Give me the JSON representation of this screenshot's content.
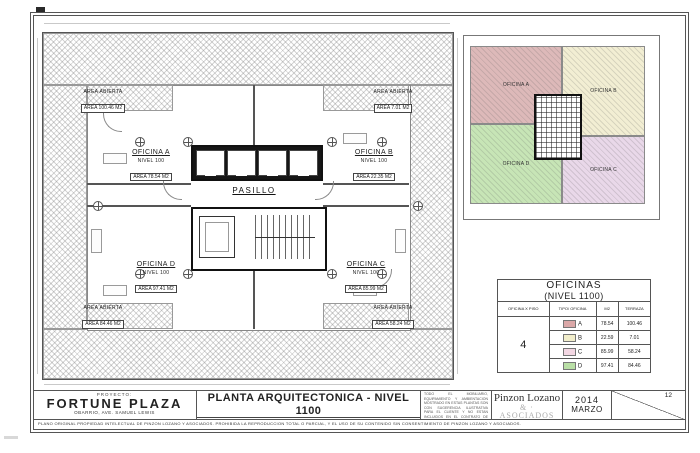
{
  "plan": {
    "corridor_label": "PASILLO",
    "offices": {
      "a": {
        "name": "OFICINA A",
        "level": "NIVEL 100",
        "area": "AREA 78.54 M2"
      },
      "b": {
        "name": "OFICINA B",
        "level": "NIVEL 100",
        "area": "AREA 22.35 M2"
      },
      "c": {
        "name": "OFICINA C",
        "level": "NIVEL 100",
        "area": "AREA 85.99 M2"
      },
      "d": {
        "name": "OFICINA D",
        "level": "NIVEL 100",
        "area": "AREA 97.41 M2"
      }
    },
    "terraces": {
      "top_left": {
        "label": "AREA ABIERTA",
        "area": "AREA 100.46 M2"
      },
      "top_right": {
        "label": "AREA ABIERTA",
        "area": "AREA 7.01 M2"
      },
      "bottom_left": {
        "label": "AREA ABIERTA",
        "area": "AREA 84.46 M2"
      },
      "bottom_right": {
        "label": "AREA ABIERTA",
        "area": "AREA 58.24 M2"
      }
    }
  },
  "key_plan": {
    "zones": {
      "a": {
        "label": "OFICINA A",
        "color": "#ddb9b9"
      },
      "b": {
        "label": "OFICINA B",
        "color": "#f2eed3"
      },
      "c": {
        "label": "OFICINA C",
        "color": "#e9d8e9"
      },
      "d": {
        "label": "OFICINA D",
        "color": "#c7e5b6"
      }
    }
  },
  "table": {
    "title_line1": "OFICINAS",
    "title_line2": "(NIVEL 1100)",
    "headers": {
      "col1": "OFICINA X PISO",
      "col2": "TIPO/ OFICINA",
      "col3": "M2",
      "col4": "TERRAZA"
    },
    "floor_value": "4",
    "rows": [
      {
        "office": "A",
        "m2": "78.54",
        "terraza": "100.46",
        "color": "#dba8a8"
      },
      {
        "office": "B",
        "m2": "22.59",
        "terraza": "7.01",
        "color": "#f2eecb"
      },
      {
        "office": "C",
        "m2": "85.99",
        "terraza": "58.24",
        "color": "#f3d7e3"
      },
      {
        "office": "D",
        "m2": "97.41",
        "terraza": "84.46",
        "color": "#b9dfa6"
      }
    ]
  },
  "title_block": {
    "project_label": "PROYECTO:",
    "project_name": "FORTUNE PLAZA",
    "project_address": "OBARRIO, AVE. SAMUEL LEWIS",
    "drawing_title": "PLANTA ARQUITECTONICA - NIVEL 1100",
    "drawing_subtitle": "OFICINAS",
    "scale_label": "ESCALA 1:50",
    "updated_line": "A C T U A L I Z A D O   12   ( M A R Z O / 2 0 1 4",
    "notes_p1": "TODO EL MOBILIARIO, EQUIPAMIENTO Y AMBIENTACION MOSTRADO EN ESTAS PLANTAS SON CON SUGERENCIA ILUSTRATIVA PARA EL CLIENTE Y NO ESTAN INCLUIDOS EN EL CONTRATO DE COMPRA-VENTA.",
    "notes_p2": "LA PROMOTORA SE RESERVA EL DERECHO DE REALIZAR CAMBIOS SIN PREVIO AVISO.",
    "firm_line1": "Pinzon Lozano",
    "firm_line2": "& · ASOCIADOS",
    "firm_line3": "ARQUITECTOS",
    "date_year": "2014",
    "date_month": "MARZO",
    "sheet_number": "12",
    "disclaimer": "PLANO ORIGINAL PROPIEDAD INTELECTUAL DE PINZON LOZANO Y ASOCIADOS. PROHIBIDA LA REPRODUCCION TOTAL O PARCIAL, Y EL USO DE SU CONTENIDO SIN CONSENTIMIENTO DE PINZON LOZANO Y ASOCIADOS."
  }
}
